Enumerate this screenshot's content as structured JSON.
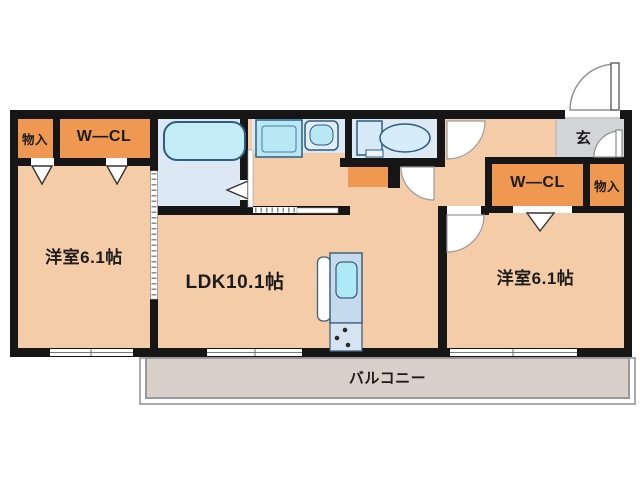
{
  "plan": {
    "type": "apartment-floor-plan",
    "layout_name": "2LDK",
    "labels": {
      "left_bedroom": "洋室6.1帖",
      "ldk": "LDK10.1帖",
      "right_bedroom": "洋室6.1帖",
      "balcony": "バルコニー",
      "entrance": "玄",
      "closet_top_left_small": "物入",
      "closet_top_left_wcl": "W—CL",
      "closet_right_wcl": "W—CL",
      "closet_right_small": "物入"
    },
    "colors": {
      "wall": "#161616",
      "room_floor": "#f4cda8",
      "closet_fill": "#ef9851",
      "wet_area_floor": "#dce8f4",
      "fixture_fill": "#b7e8f4",
      "fixture_stroke": "#2d5d80",
      "entrance_floor": "#d3d4d6",
      "balcony_floor": "#d9d1c9",
      "text": "#1c1c1c"
    }
  }
}
